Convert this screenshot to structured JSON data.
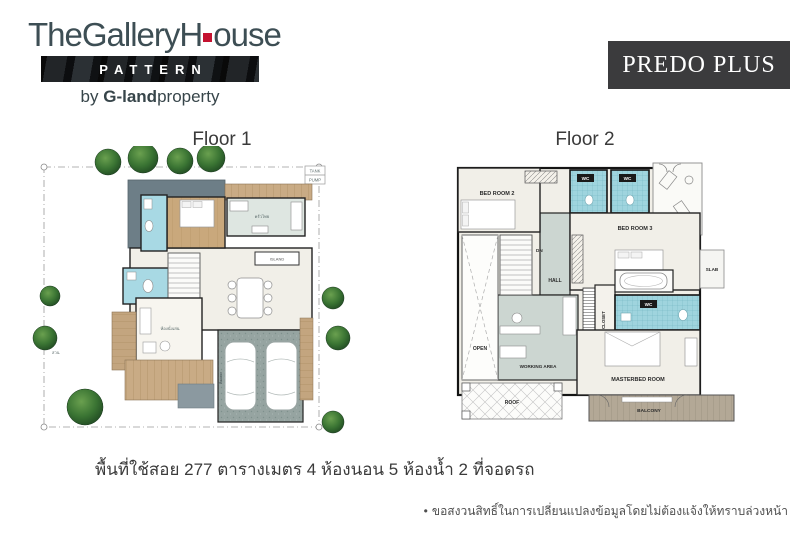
{
  "brand": {
    "logo_part1": "TheGalleryH",
    "logo_part2": "ouse",
    "pattern_label": "PATTERN",
    "byline_prefix": "by ",
    "byline_bold": "G-land",
    "byline_rest": "property",
    "accent_red": "#c41230"
  },
  "model": {
    "name": "PREDO PLUS",
    "box_color": "#3b3b3d",
    "text_color": "#ffffff"
  },
  "floor1": {
    "title": "Floor 1",
    "labels": {
      "tank": "TANK",
      "pump": "PUMP",
      "island": "ISLAND",
      "kitchen": "ครัวไทย",
      "living": "ห้องนั่งเล่น",
      "garden": "สวน",
      "parking": "ที่จอดรถ"
    }
  },
  "floor2": {
    "title": "Floor 2",
    "labels": {
      "bedroom2": "BED ROOM 2",
      "wc1": "WC",
      "wc2": "WC",
      "bedroom3": "BED ROOM 3",
      "dn": "DN",
      "hall": "HALL",
      "open": "OPEN",
      "walk_in_closet": "WALK IN CLOSET",
      "wc3": "WC",
      "slab": "SLAB",
      "masterbed": "MASTERBED ROOM",
      "working_area": "WORKING AREA",
      "roof": "ROOF",
      "balcony": "BALCONY"
    }
  },
  "summary": {
    "text": "พื้นที่ใช้สอย 277 ตารางเมตร 4 ห้องนอน 5 ห้องน้ำ 2 ที่จอดรถ"
  },
  "disclaimer": {
    "bullet": "•",
    "text": "ขอสงวนสิทธิ์ในการเปลี่ยนแปลงข้อมูลโดยไม่ต้องแจ้งให้ทราบล่วงหน้า"
  },
  "colors": {
    "roof_gray": "#6d7e87",
    "wood": "#c9a87c",
    "bath_blue": "#a8d9e4",
    "tile_blue": "#9fd4de",
    "sage": "#ccd6d1",
    "kitchen_sage": "#dee6e1",
    "carport_gray": "#96a4a1",
    "floor_cream": "#f1efe8",
    "tree_green": "#33682c"
  }
}
